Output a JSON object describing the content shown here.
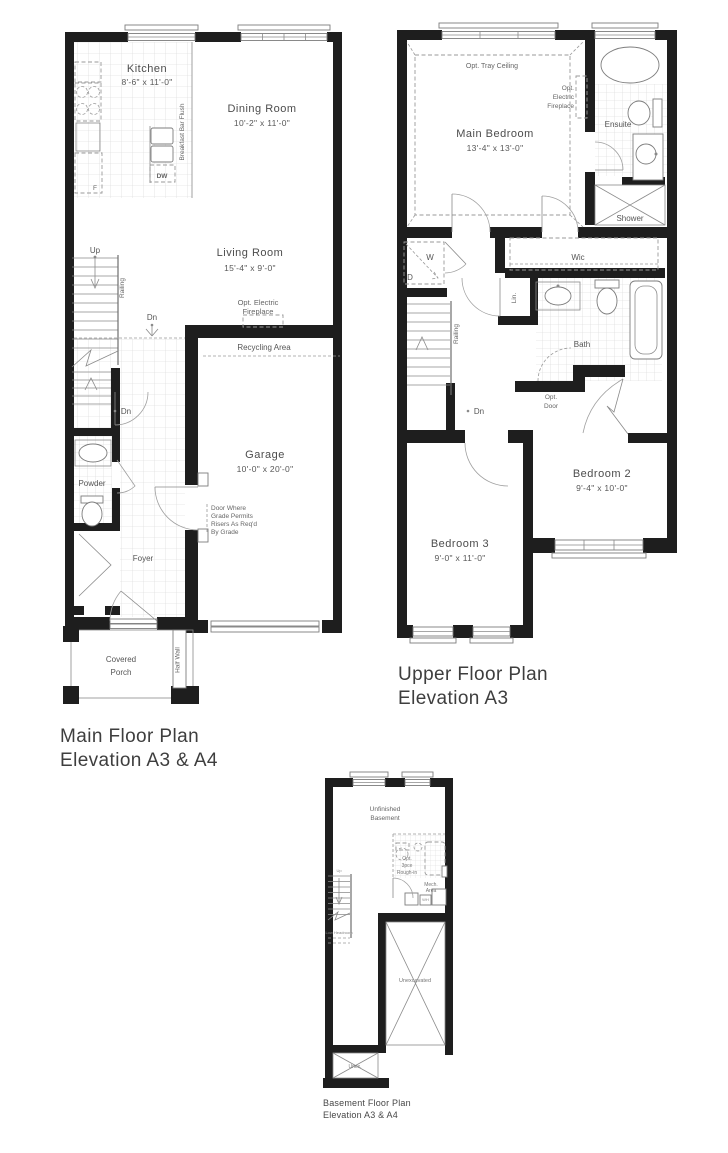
{
  "colors": {
    "wall": "#1e1e1e",
    "line": "#8a8a8a",
    "text": "#4a4a4a"
  },
  "main_plan": {
    "title": [
      "Main Floor Plan",
      "Elevation A3 & A4"
    ],
    "rooms": {
      "kitchen": {
        "name": "Kitchen",
        "dims": "8'-6\" x 11'-0\""
      },
      "dining_room": {
        "name": "Dining Room",
        "dims": "10'-2\" x 11'-0\""
      },
      "living_room": {
        "name": "Living Room",
        "dims": "15'-4\" x 9'-0\""
      },
      "garage": {
        "name": "Garage",
        "dims": "10'-0\" x 20'-0\""
      },
      "powder": {
        "name": "Powder"
      },
      "foyer": {
        "name": "Foyer"
      },
      "covered_porch": {
        "lines": [
          "Covered",
          "Porch"
        ]
      }
    },
    "labels": {
      "up": "Up",
      "dn_stairs": "Dn",
      "dn_foyer": "Dn",
      "railing": "Railing",
      "opt_electric_fireplace": [
        "Opt. Electric",
        "Fireplace"
      ],
      "recycling_area": "Recycling Area",
      "breakfast_bar": "Breakfast Bar Flush",
      "dw": "DW",
      "fridge": "F",
      "half_wall": "Half Wall",
      "grade_note": [
        "Door Where",
        "Grade Permits",
        "Risers As Req'd",
        "By Grade"
      ]
    }
  },
  "upper_plan": {
    "title": [
      "Upper Floor Plan",
      "Elevation A3"
    ],
    "rooms": {
      "main_bedroom": {
        "name": "Main Bedroom",
        "dims": "13'-4\" x 13'-0\""
      },
      "ensuite": {
        "name": "Ensuite"
      },
      "shower": {
        "name": "Shower"
      },
      "wic": {
        "name": "Wic"
      },
      "bath": {
        "name": "Bath"
      },
      "bedroom2": {
        "name": "Bedroom 2",
        "dims": "9'-4\" x 10'-0\""
      },
      "bedroom3": {
        "name": "Bedroom 3",
        "dims": "9'-0\" x 11'-0\""
      }
    },
    "labels": {
      "opt_tray_ceiling": "Opt. Tray Ceiling",
      "opt_electric_fireplace": [
        "Opt.",
        "Electric",
        "Fireplace"
      ],
      "washer": "W",
      "dryer": "D",
      "linen": "Lin.",
      "railing": "Railing",
      "dn": "Dn",
      "opt_door": [
        "Opt.",
        "Door"
      ]
    }
  },
  "basement_plan": {
    "title": [
      "Basement Floor Plan",
      "Elevation A3 & A4"
    ],
    "rooms": {
      "unfinished_basement": {
        "lines": [
          "Unfinished",
          "Basement"
        ]
      },
      "unexcavated": {
        "name": "Unexcavated"
      },
      "unex": {
        "name": "Unex."
      }
    },
    "labels": {
      "up": "Up",
      "opt_rough_in": [
        "Opt.",
        "3pce",
        "Rough-in"
      ],
      "mech_area": [
        "Mech.",
        "Area"
      ],
      "low_headroom": "Low Headroom",
      "wh": "WH"
    }
  }
}
